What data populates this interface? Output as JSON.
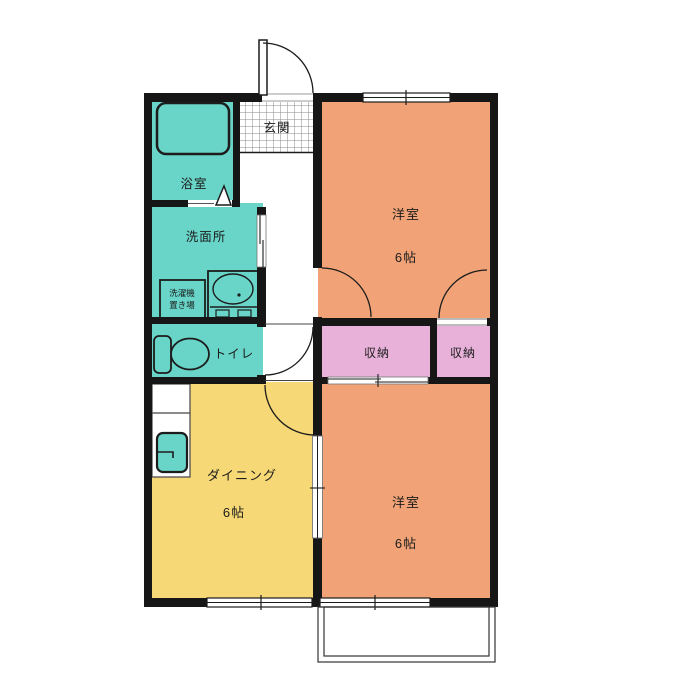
{
  "plan": {
    "entrance": {
      "label": "玄関"
    },
    "bathroom": {
      "label": "浴室"
    },
    "washroom": {
      "label": "洗面所"
    },
    "laundry": {
      "line1": "洗濯機",
      "line2": "置き場"
    },
    "toilet": {
      "label": "トイレ"
    },
    "closet_left": {
      "label": "収納"
    },
    "closet_right": {
      "label": "収納"
    },
    "western_top": {
      "label": "洋室",
      "size": "6帖"
    },
    "dining": {
      "label": "ダイニング",
      "size": "6帖"
    },
    "western_bottom": {
      "label": "洋室",
      "size": "6帖"
    }
  },
  "colors": {
    "wall": "#161616",
    "western_room": "#f1a377",
    "dining": "#f6d976",
    "wet_area": "#69d5c8",
    "closet": "#e8b1da",
    "background": "#ffffff"
  }
}
